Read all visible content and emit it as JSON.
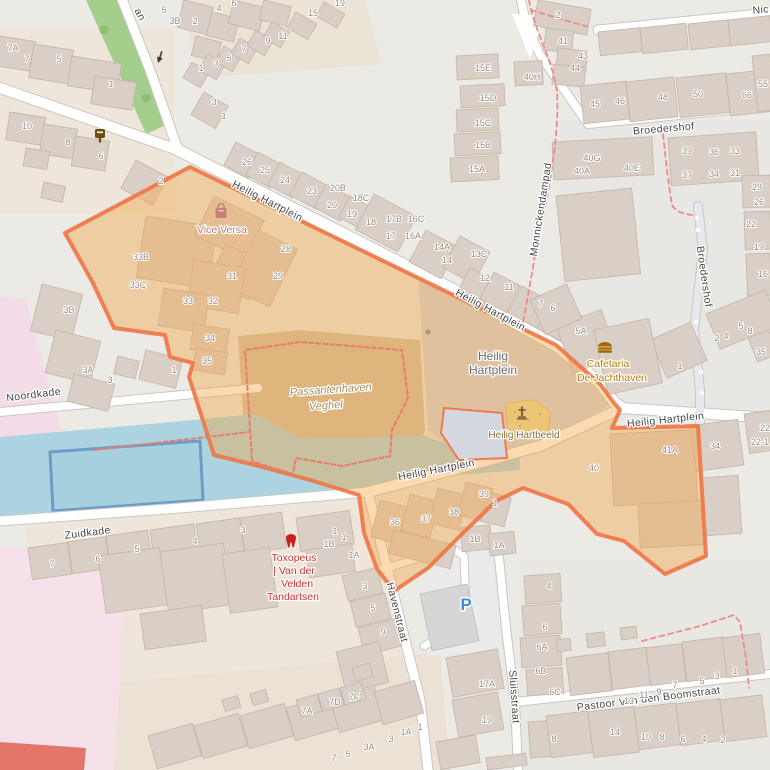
{
  "map": {
    "description": "OpenStreetMap-style map of Heilig Hartplein, Veghel with highlighted area",
    "colors": {
      "land": "#eceae5",
      "water": "#abd4e0",
      "basin_stroke": "#6d9cc8",
      "building": "#d9cfc6",
      "green": "#a5ce8d",
      "pink_zone": "#f3dce8",
      "red_block": "#e4756b",
      "highlight_fill": "rgba(244,162,63,0.40)",
      "highlight_stroke": "rgba(238,118,70,0.9)",
      "footpath_dash": "#ee8a8a"
    },
    "street_labels": [
      {
        "text": "an",
        "x": 137,
        "y": 16,
        "rot": 62
      },
      {
        "text": "Heilig Hartplein",
        "x": 266,
        "y": 204,
        "rot": 27
      },
      {
        "text": "Heilig Hartplein",
        "x": 489,
        "y": 313,
        "rot": 28
      },
      {
        "text": "Heilig Hartplein",
        "x": 666,
        "y": 423,
        "rot": -6
      },
      {
        "text": "Heilig Hartplein",
        "x": 437,
        "y": 473,
        "rot": -11
      },
      {
        "text": "Noordkade",
        "x": 34,
        "y": 398,
        "rot": -7
      },
      {
        "text": "Zuidkade",
        "x": 88,
        "y": 536,
        "rot": -7
      },
      {
        "text": "Broedershof",
        "x": 664,
        "y": 132,
        "rot": -5
      },
      {
        "text": "Broedershof",
        "x": 701,
        "y": 277,
        "rot": 82
      },
      {
        "text": "Monnickendampad",
        "x": 544,
        "y": 210,
        "rot": -81
      },
      {
        "text": "Havenstraat",
        "x": 394,
        "y": 613,
        "rot": 76
      },
      {
        "text": "Sluisstraat",
        "x": 511,
        "y": 697,
        "rot": 86
      },
      {
        "text": "Pastoor Van den Boomstraat",
        "x": 649,
        "y": 702,
        "rot": -7
      },
      {
        "text": "Nic",
        "x": 761,
        "y": 13,
        "rot": -5
      }
    ],
    "place_labels": [
      {
        "text": "Heilig",
        "x": 493,
        "y": 360,
        "class": "place"
      },
      {
        "text": "Hartplein",
        "x": 493,
        "y": 374,
        "class": "place"
      },
      {
        "text": "Passantenhaven",
        "x": 331,
        "y": 393,
        "class": "marina",
        "rot": -4
      },
      {
        "text": "Veghel",
        "x": 326,
        "y": 409,
        "class": "marina",
        "rot": -4
      }
    ],
    "poi_labels": [
      {
        "text": "Vice Versa",
        "x": 222,
        "y": 233,
        "class": "shop"
      },
      {
        "text": "Cafetaria",
        "x": 608,
        "y": 367,
        "class": "food"
      },
      {
        "text": "De Jachthaven",
        "x": 612,
        "y": 381,
        "class": "food"
      },
      {
        "text": "Heilig Hartbeeld",
        "x": 524,
        "y": 438,
        "class": "memorial"
      },
      {
        "text": "Toxopeus",
        "x": 294,
        "y": 561,
        "class": "dentist"
      },
      {
        "text": "| Van der",
        "x": 294,
        "y": 574,
        "class": "dentist"
      },
      {
        "text": "Velden",
        "x": 297,
        "y": 587,
        "class": "dentist"
      },
      {
        "text": "Tandartsen",
        "x": 293,
        "y": 600,
        "class": "dentist"
      },
      {
        "text": "P",
        "x": 466,
        "y": 610,
        "class": "parking"
      }
    ],
    "house_numbers": [
      [
        "7A",
        13,
        51
      ],
      [
        "7",
        27,
        62
      ],
      [
        "5",
        59,
        62
      ],
      [
        "1",
        111,
        87
      ],
      [
        "5",
        164,
        13
      ],
      [
        "3B",
        175,
        24
      ],
      [
        "2",
        195,
        24
      ],
      [
        "4",
        219,
        11
      ],
      [
        "6",
        234,
        6
      ],
      [
        "1",
        201,
        71
      ],
      [
        "3",
        216,
        66
      ],
      [
        "5",
        229,
        61
      ],
      [
        "7",
        244,
        52
      ],
      [
        "9",
        268,
        44
      ],
      [
        "11",
        283,
        39
      ],
      [
        "15",
        313,
        16
      ],
      [
        "19",
        340,
        6
      ],
      [
        "10",
        27,
        129
      ],
      [
        "8",
        68,
        145
      ],
      [
        "6",
        101,
        159
      ],
      [
        "2",
        161,
        184
      ],
      [
        "3",
        214,
        105
      ],
      [
        "1",
        224,
        119
      ],
      [
        "26",
        247,
        165
      ],
      [
        "25",
        265,
        173
      ],
      [
        "24",
        285,
        183
      ],
      [
        "23",
        312,
        194
      ],
      [
        "20B",
        338,
        191
      ],
      [
        "20",
        332,
        208
      ],
      [
        "18C",
        361,
        201
      ],
      [
        "19",
        352,
        217
      ],
      [
        "18",
        371,
        225
      ],
      [
        "2",
        558,
        18
      ],
      [
        "41",
        563,
        44
      ],
      [
        "43",
        583,
        59
      ],
      [
        "44",
        575,
        71
      ],
      [
        "45",
        595,
        107
      ],
      [
        "46",
        620,
        104
      ],
      [
        "48",
        663,
        100
      ],
      [
        "50",
        698,
        97
      ],
      [
        "66",
        747,
        98
      ],
      [
        "55",
        763,
        87
      ],
      [
        "15E",
        483,
        71
      ],
      [
        "40H",
        532,
        80
      ],
      [
        "15D",
        488,
        101
      ],
      [
        "15C",
        483,
        126
      ],
      [
        "15B",
        483,
        148
      ],
      [
        "15A",
        477,
        172
      ],
      [
        "40G",
        592,
        161
      ],
      [
        "40A",
        582,
        174
      ],
      [
        "40E",
        632,
        171
      ],
      [
        "39",
        687,
        154
      ],
      [
        "36",
        714,
        155
      ],
      [
        "33",
        735,
        154
      ],
      [
        "37",
        687,
        178
      ],
      [
        "34",
        714,
        177
      ],
      [
        "31",
        735,
        176
      ],
      [
        "29",
        757,
        190
      ],
      [
        "26",
        759,
        205
      ],
      [
        "22",
        751,
        227
      ],
      [
        "19",
        759,
        250
      ],
      [
        "16",
        763,
        277
      ],
      [
        "17B",
        394,
        222
      ],
      [
        "16C",
        416,
        222
      ],
      [
        "17",
        391,
        239
      ],
      [
        "16A",
        413,
        239
      ],
      [
        "14A",
        442,
        250
      ],
      [
        "14",
        447,
        263
      ],
      [
        "13C",
        479,
        257
      ],
      [
        "12",
        485,
        281
      ],
      [
        "11",
        509,
        290
      ],
      [
        "7",
        541,
        307
      ],
      [
        "6",
        553,
        311
      ],
      [
        "5A",
        581,
        334
      ],
      [
        "33B",
        141,
        260
      ],
      [
        "33C",
        138,
        288
      ],
      [
        "33",
        188,
        304
      ],
      [
        "32",
        213,
        304
      ],
      [
        "31",
        232,
        279
      ],
      [
        "29",
        278,
        279
      ],
      [
        "28",
        286,
        252
      ],
      [
        "34",
        210,
        341
      ],
      [
        "35",
        207,
        364
      ],
      [
        "3B",
        69,
        313
      ],
      [
        "3A",
        88,
        373
      ],
      [
        "3",
        110,
        383
      ],
      [
        "1",
        174,
        373
      ],
      [
        "2",
        717,
        341
      ],
      [
        "4",
        726,
        339
      ],
      [
        "5",
        741,
        329
      ],
      [
        "8",
        750,
        334
      ],
      [
        "35",
        761,
        355
      ],
      [
        "1",
        680,
        369
      ],
      [
        "40",
        594,
        471
      ],
      [
        "41A",
        670,
        453
      ],
      [
        "34",
        715,
        449
      ],
      [
        "22",
        765,
        431
      ],
      [
        "22-1",
        760,
        445
      ],
      [
        "36",
        395,
        525
      ],
      [
        "37",
        426,
        522
      ],
      [
        "38",
        454,
        515
      ],
      [
        "39",
        484,
        497
      ],
      [
        "1",
        495,
        506
      ],
      [
        "1B",
        475,
        542
      ],
      [
        "1A",
        499,
        548
      ],
      [
        "3",
        243,
        533
      ],
      [
        "4",
        195,
        544
      ],
      [
        "5",
        137,
        552
      ],
      [
        "6",
        98,
        562
      ],
      [
        "7",
        52,
        567
      ],
      [
        "1",
        335,
        534
      ],
      [
        "1B",
        329,
        547
      ],
      [
        "1",
        344,
        540
      ],
      [
        "1A",
        354,
        558
      ],
      [
        "3",
        365,
        589
      ],
      [
        "5",
        373,
        611
      ],
      [
        "9",
        383,
        635
      ],
      [
        "17A",
        487,
        687
      ],
      [
        "19",
        487,
        723
      ],
      [
        "7A",
        307,
        714
      ],
      [
        "7D",
        335,
        705
      ],
      [
        "7F",
        354,
        700
      ],
      [
        "7",
        334,
        761
      ],
      [
        "5",
        348,
        757
      ],
      [
        "3A",
        369,
        750
      ],
      [
        "3",
        391,
        742
      ],
      [
        "1A",
        406,
        735
      ],
      [
        "1",
        420,
        730
      ],
      [
        "4",
        549,
        589
      ],
      [
        "6",
        545,
        630
      ],
      [
        "6A",
        542,
        650
      ],
      [
        "6B",
        541,
        674
      ],
      [
        "6C",
        555,
        695
      ],
      [
        "13",
        629,
        704
      ],
      [
        "11",
        644,
        698
      ],
      [
        "9",
        659,
        695
      ],
      [
        "7",
        675,
        688
      ],
      [
        "5",
        702,
        684
      ],
      [
        "3",
        717,
        679
      ],
      [
        "1",
        735,
        674
      ],
      [
        "8",
        554,
        742
      ],
      [
        "14",
        615,
        735
      ],
      [
        "10",
        646,
        740
      ],
      [
        "8",
        662,
        740
      ],
      [
        "6",
        683,
        742
      ],
      [
        "4",
        704,
        742
      ],
      [
        "2",
        723,
        743
      ]
    ],
    "icons": [
      {
        "name": "postbox-icon",
        "x": 100,
        "y": 136
      },
      {
        "name": "oneway-arrow-icon",
        "x": 160,
        "y": 57,
        "rot": 18
      },
      {
        "name": "shop-bag-icon",
        "x": 221,
        "y": 212
      },
      {
        "name": "burger-icon",
        "x": 605,
        "y": 348
      },
      {
        "name": "statue-icon",
        "x": 522,
        "y": 414
      },
      {
        "name": "tooth-icon",
        "x": 291,
        "y": 542
      },
      {
        "name": "tree-icon",
        "x": 104,
        "y": 30
      },
      {
        "name": "tree-icon",
        "x": 146,
        "y": 98
      }
    ]
  }
}
